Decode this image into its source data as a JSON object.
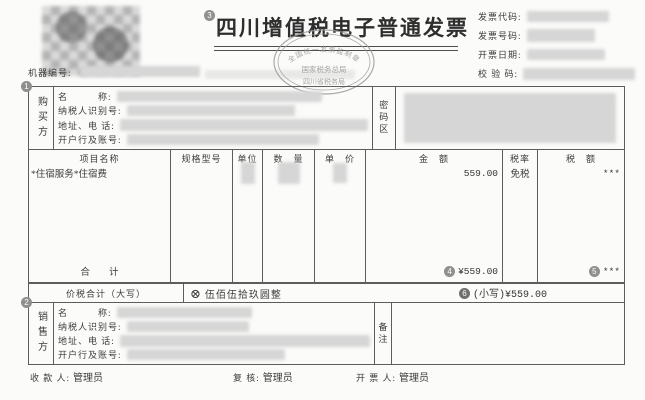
{
  "colors": {
    "paper": "#fbfbf9",
    "ink": "#3c3c3c",
    "border": "#5d5d5d",
    "redaction": "#d6d6d6",
    "stamp": "#9a9a9a",
    "badge": "#8f8f8f"
  },
  "header": {
    "machine_no_label": "机器编号:",
    "title_badge": "3",
    "title": "四川增值税电子普通发票",
    "stamp": {
      "arc_top": "全国统一发票监制章",
      "middle": "国家税务总局",
      "bottom": "四川省税务局"
    },
    "fields": [
      {
        "label": "发票代码:"
      },
      {
        "label": "发票号码:"
      },
      {
        "label": "开票日期:"
      },
      {
        "label": "校 验 码:"
      }
    ]
  },
  "buyer": {
    "badge": "1",
    "section_label": "购买方",
    "field_labels": [
      "名　　　称:",
      "纳税人识别号:",
      "地址、电 话:",
      "开户行及账号:"
    ],
    "password_label": "密码区"
  },
  "items_table": {
    "headers": [
      "项目名称",
      "规格型号",
      "单位",
      "数　量",
      "单　价",
      "金　额",
      "税率",
      "税　额"
    ],
    "row": {
      "name": "*住宿服务*住宿费",
      "amount": "559.00",
      "tax_rate": "免税",
      "tax": "***"
    },
    "total": {
      "label": "合　　计",
      "amount_badge": "4",
      "amount": "¥559.00",
      "tax_badge": "5",
      "tax": "***"
    }
  },
  "sum_row": {
    "label": "价税合计（大写）",
    "cross_icon": "⊗",
    "amount_in_words": "伍佰伍拾玖圆整",
    "small_badge": "6",
    "small_amount": "(小写)¥559.00"
  },
  "seller": {
    "badge": "2",
    "section_label": "销售方",
    "field_labels": [
      "名　　　称:",
      "纳税人识别号:",
      "地址、电 话:",
      "开户行及账号:"
    ],
    "remarks_label": "备注"
  },
  "footer": {
    "payee_label": "收 款 人:",
    "payee": "管理员",
    "reviewer_label": "复 核:",
    "reviewer": "管理员",
    "issuer_label": "开 票 人:",
    "issuer": "管理员"
  }
}
